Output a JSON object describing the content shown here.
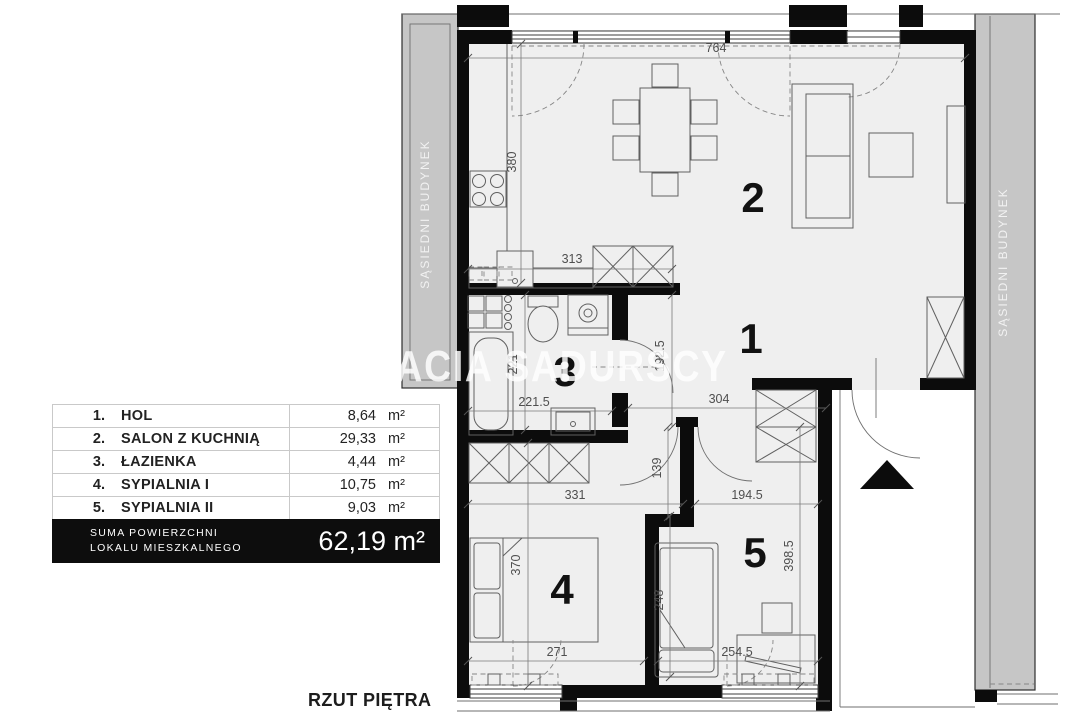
{
  "title": "RZUT PIĘTRA",
  "watermark": "BRACIA SADURSCY",
  "neighbor": {
    "left": "SĄSIEDNI BUDYNEK",
    "right": "SĄSIEDNI BUDYNEK"
  },
  "room_labels": {
    "hol": "1",
    "salon": "2",
    "lazienka": "3",
    "sypialnia1": "4",
    "sypialnia2": "5"
  },
  "dims": {
    "v764": "764",
    "v380": "380",
    "v313": "313",
    "v221": "221",
    "v221_5": "221.5",
    "v192_5": "192.5",
    "v304": "304",
    "v139": "139",
    "v194_5": "194.5",
    "v331": "331",
    "v370": "370",
    "v271": "271",
    "v248": "248",
    "v254_5": "254.5",
    "v398_5": "398.5"
  },
  "legend": {
    "rows": [
      {
        "no": "1.",
        "name": "HOL",
        "area": "8,64",
        "unit": "m²"
      },
      {
        "no": "2.",
        "name": "SALON Z KUCHNIĄ",
        "area": "29,33",
        "unit": "m²"
      },
      {
        "no": "3.",
        "name": "ŁAZIENKA",
        "area": "4,44",
        "unit": "m²"
      },
      {
        "no": "4.",
        "name": "SYPIALNIA I",
        "area": "10,75",
        "unit": "m²"
      },
      {
        "no": "5.",
        "name": "SYPIALNIA II",
        "area": "9,03",
        "unit": "m²"
      }
    ],
    "summary": {
      "label_line1": "SUMA POWIERZCHNI",
      "label_line2": "LOKALU MIESZKALNEGO",
      "value": "62,19",
      "unit": "m²"
    }
  },
  "colors": {
    "wall": "#0c0c0c",
    "floor": "#efefef",
    "neighbor_building": "#c6c6c6",
    "summary_bg": "#0d0d0d"
  }
}
